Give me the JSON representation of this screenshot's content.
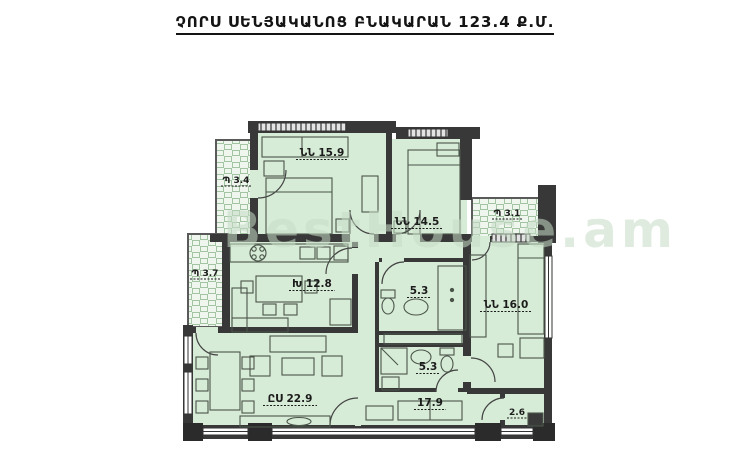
{
  "title": "ՉՈՐՍ ՍԵՆՅԱԿԱՆՈՑ ԲՆԱԿԱՐԱՆ 123.4 Ք.Մ.",
  "total_area": "123.4",
  "area_unit": "Ք.Մ.",
  "watermark": "BestHouse.am",
  "rooms": [
    {
      "id": "bedroom-1",
      "type": "bedroom",
      "label": "ՆՆ 15.9",
      "area": "15.9"
    },
    {
      "id": "bedroom-2",
      "type": "bedroom",
      "label": "ՆՆ 14.5",
      "area": "14.5"
    },
    {
      "id": "bedroom-3",
      "type": "bedroom",
      "label": "ՆՆ 16.0",
      "area": "16.0"
    },
    {
      "id": "kitchen",
      "type": "kitchen",
      "label": "Խ 12.8",
      "area": "12.8"
    },
    {
      "id": "living-room",
      "type": "living",
      "label": "ԸՍ 22.9",
      "area": "22.9"
    },
    {
      "id": "hallway",
      "type": "hall",
      "label": "17.9",
      "area": "17.9"
    },
    {
      "id": "bathroom-upper",
      "type": "bathroom",
      "label": "5.3",
      "area": "5.3"
    },
    {
      "id": "bathroom-lower",
      "type": "bathroom",
      "label": "5.3",
      "area": "5.3"
    },
    {
      "id": "storage",
      "type": "storage",
      "label": "2.6",
      "area": "2.6"
    },
    {
      "id": "balcony-top",
      "type": "balcony",
      "label": "Պ 3.4",
      "area": "3.4"
    },
    {
      "id": "balcony-left",
      "type": "balcony",
      "label": "Պ 3.7",
      "area": "3.7"
    },
    {
      "id": "balcony-right",
      "type": "balcony",
      "label": "Պ 3.1",
      "area": "3.1"
    }
  ],
  "colors": {
    "room_fill": "#d7ecd7",
    "wall": "#383838",
    "furniture_line": "#4a554a",
    "balcony_grid": "#a3c4a3",
    "watermark": "#c6dcc6",
    "title_text": "#141414"
  }
}
